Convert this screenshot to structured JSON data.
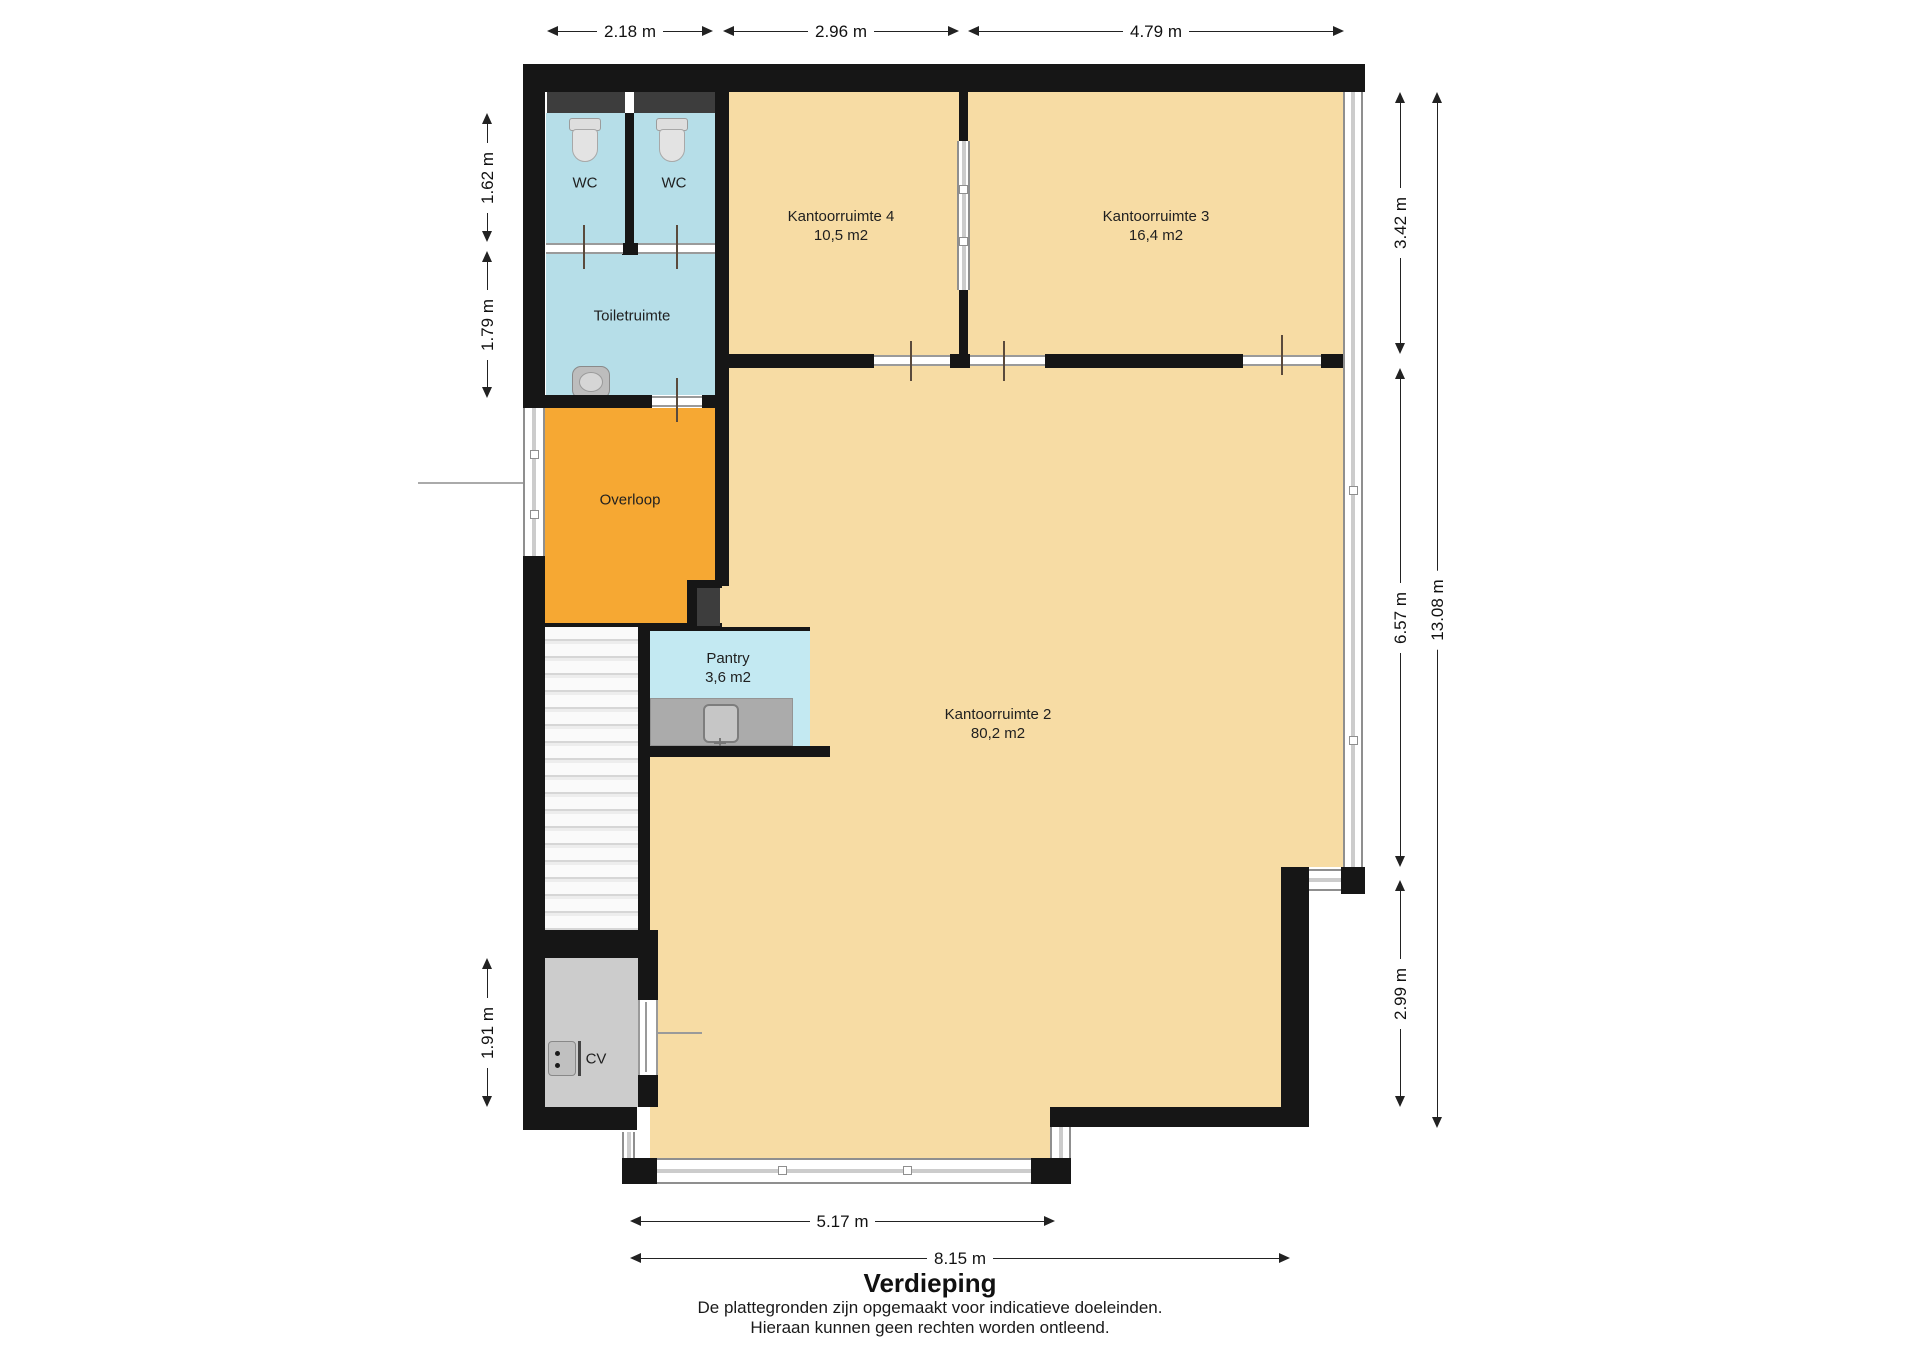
{
  "title": "Verdieping",
  "disclaimer": {
    "line1": "De plattegronden zijn opgemaakt voor indicatieve doeleinden.",
    "line2": "Hieraan kunnen geen rechten worden ontleend."
  },
  "rooms": {
    "wc_left": {
      "name": "WC"
    },
    "wc_right": {
      "name": "WC"
    },
    "toiletruimte": {
      "name": "Toiletruimte"
    },
    "overloop": {
      "name": "Overloop"
    },
    "pantry": {
      "name": "Pantry",
      "area": "3,6 m2"
    },
    "kantoorruimte_4": {
      "name": "Kantoorruimte 4",
      "area": "10,5 m2"
    },
    "kantoorruimte_3": {
      "name": "Kantoorruimte 3",
      "area": "16,4 m2"
    },
    "kantoorruimte_2": {
      "name": "Kantoorruimte 2",
      "area": "80,2 m2"
    },
    "cv": {
      "name": "CV"
    }
  },
  "dimensions": {
    "top": [
      "2.18 m",
      "2.96 m",
      "4.79 m"
    ],
    "left": [
      "1.62 m",
      "1.79 m",
      "1.91 m"
    ],
    "right": [
      "3.42 m",
      "6.57 m",
      "2.99 m",
      "13.08 m"
    ],
    "bottom": [
      "5.17 m",
      "8.15 m"
    ]
  },
  "fixtures": [
    "toilet-icon",
    "toilet-icon",
    "washbasin-icon",
    "kitchen-sink-icon",
    "boiler-icon",
    "staircase"
  ],
  "colors": {
    "wall": "#161616",
    "floor_office": "#f7dca4",
    "floor_wet": "#b6dee8",
    "floor_pantry": "#c3e9f2",
    "floor_hall": "#f6a833",
    "floor_utility": "#cccccc",
    "fixture_dark": "#3d3d3d",
    "glass_frame": "#8f8f8f",
    "dim": "#222222"
  }
}
